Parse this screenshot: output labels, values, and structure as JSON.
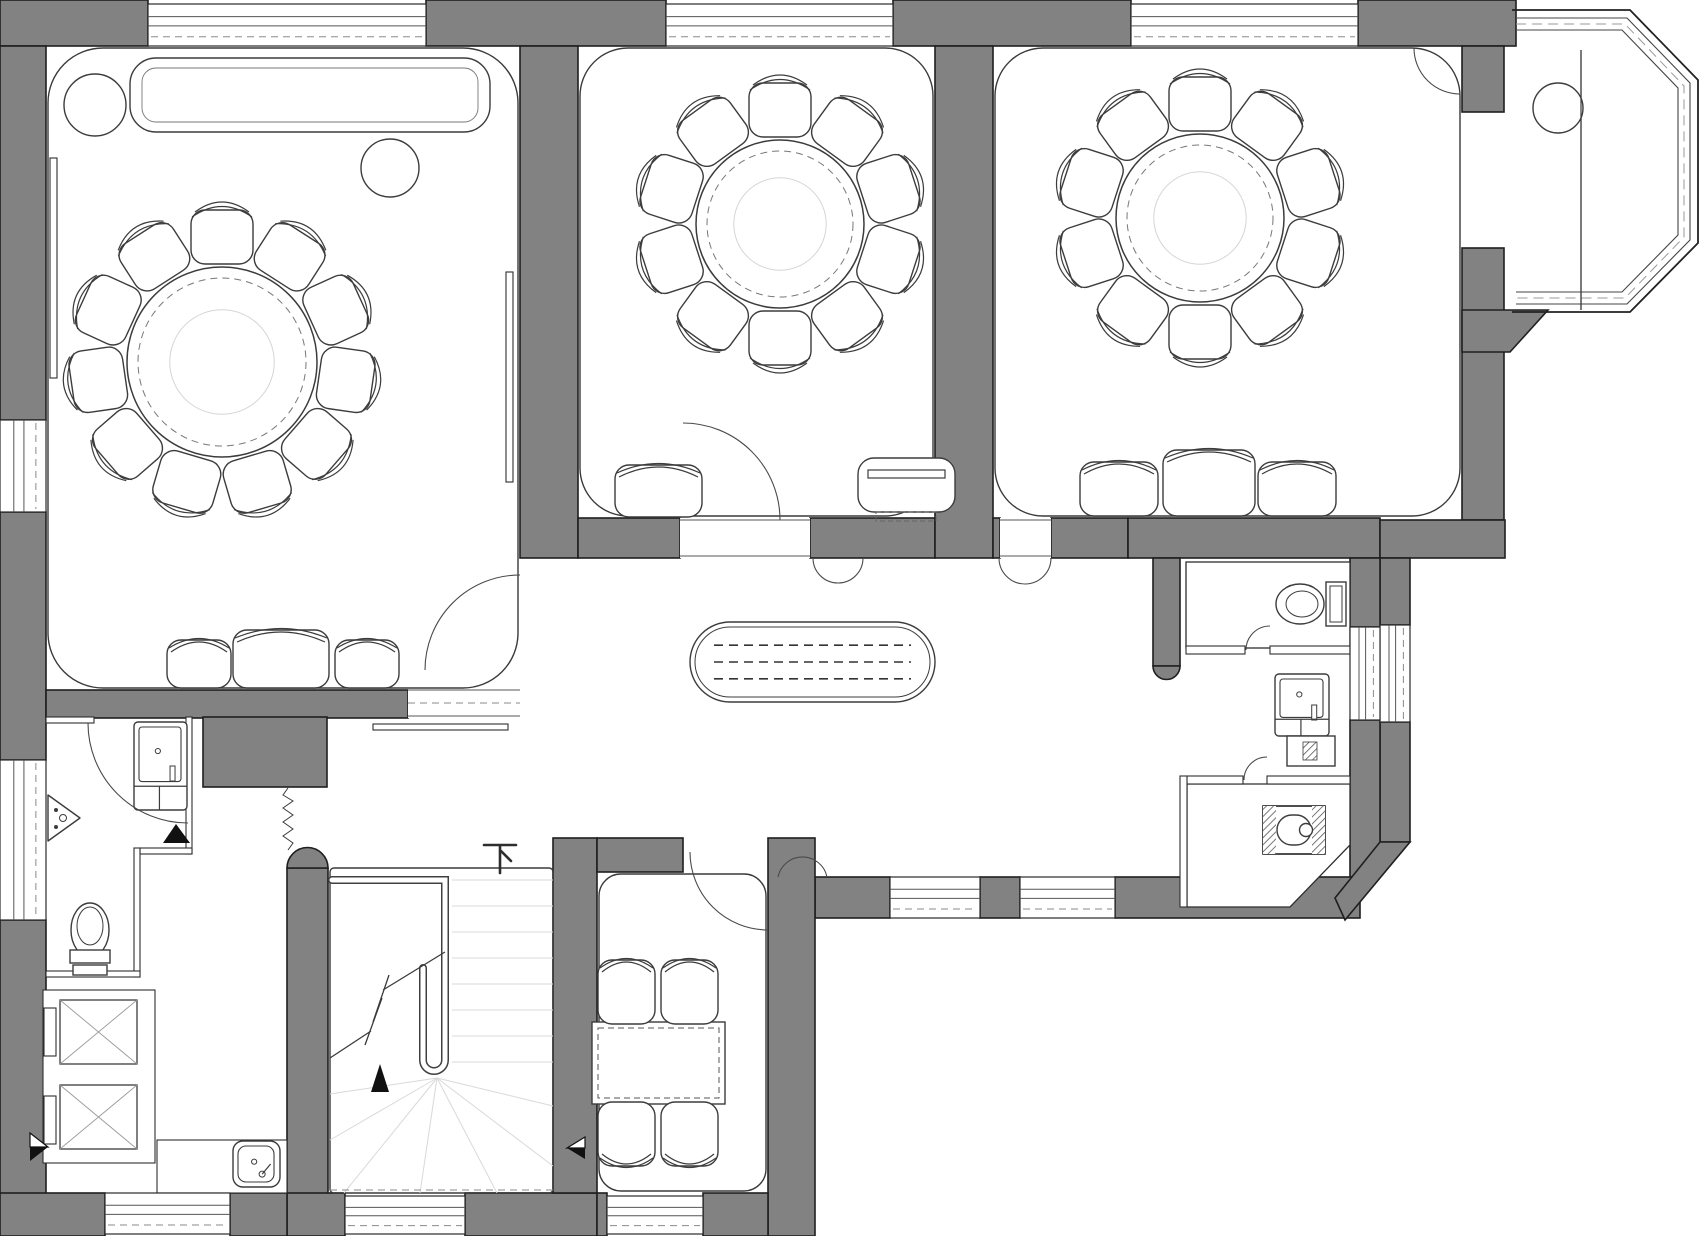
{
  "meta": {
    "title": "restaurant-floor-plan",
    "canvas": {
      "w": 1700,
      "h": 1236
    }
  },
  "palette": {
    "wall": "#828282",
    "wall_stroke": "#1f1f1f",
    "line": "#3c3c3c",
    "faint": "#d9d9d9",
    "dash": "#5a5a5a",
    "paper": "#ffffff",
    "black": "#111111"
  },
  "labels": {
    "stair_down": "下"
  },
  "walls": {
    "rects": [
      [
        0,
        0,
        148,
        46,
        "top-wall-left"
      ],
      [
        426,
        0,
        240,
        46,
        "top-pier-1"
      ],
      [
        893,
        0,
        238,
        46,
        "top-pier-2"
      ],
      [
        1358,
        0,
        158,
        46,
        "top-pier-3"
      ],
      [
        1462,
        46,
        42,
        66,
        "bay-left-pier"
      ],
      [
        1462,
        248,
        42,
        272,
        "bay-right-wall"
      ],
      [
        0,
        46,
        46,
        374,
        "left-wall-upper"
      ],
      [
        0,
        512,
        46,
        248,
        "left-wall-mid"
      ],
      [
        0,
        920,
        46,
        316,
        "left-wall-lower"
      ],
      [
        46,
        690,
        362,
        28,
        "room1-bottom-wall"
      ],
      [
        520,
        46,
        58,
        512,
        "divider-room1-room2"
      ],
      [
        578,
        518,
        102,
        40,
        "room2-bottom-wall-left"
      ],
      [
        810,
        518,
        125,
        40,
        "room2-bottom-wall-right"
      ],
      [
        935,
        46,
        58,
        512,
        "divider-room2-room3"
      ],
      [
        993,
        518,
        7,
        40,
        "room3-bottom-wall-a"
      ],
      [
        1051,
        518,
        77,
        40,
        "room3-bottom-wall-b"
      ],
      [
        1128,
        518,
        252,
        40,
        "bathroom-top-wall"
      ],
      [
        1153,
        558,
        27,
        108,
        "bathroom-left-wall"
      ],
      [
        1380,
        520,
        125,
        38,
        "wing-bottom-wall"
      ],
      [
        1380,
        558,
        30,
        67,
        "right-wall-upper"
      ],
      [
        1380,
        722,
        30,
        120,
        "right-wall-lower"
      ],
      [
        1350,
        558,
        30,
        69,
        "wc-strip-upper"
      ],
      [
        1350,
        720,
        30,
        157,
        "wc-strip-lower"
      ],
      [
        815,
        877,
        75,
        41,
        "corridor-bottom-a"
      ],
      [
        980,
        877,
        40,
        41,
        "corridor-bottom-b"
      ],
      [
        1115,
        877,
        245,
        41,
        "corridor-bottom-c"
      ],
      [
        203,
        717,
        124,
        70,
        "entry-top-wall"
      ],
      [
        287,
        868,
        41,
        368,
        "stair-left-wall"
      ],
      [
        287,
        1193,
        58,
        43,
        "stair-bottom-wall-l"
      ],
      [
        465,
        1193,
        132,
        43,
        "stair-bottom-wall-r"
      ],
      [
        553,
        838,
        44,
        355,
        "dining-left-wall"
      ],
      [
        597,
        838,
        86,
        34,
        "dining-top-stub"
      ],
      [
        768,
        838,
        47,
        398,
        "dining-right-wall"
      ],
      [
        597,
        1193,
        10,
        43,
        "dining-bottom-a"
      ],
      [
        703,
        1193,
        65,
        43,
        "dining-bottom-b"
      ],
      [
        0,
        1193,
        105,
        43,
        "bottom-left-corner"
      ],
      [
        230,
        1193,
        57,
        43,
        "bottom-mid-wall"
      ]
    ],
    "polys": [
      [
        "1462,310 1548,310 1510,352 1462,352",
        "bay-bottom-pier"
      ],
      [
        "1380,842 1410,842 1345,920 1335,898",
        "corner-chamfer-wall"
      ]
    ],
    "caps": [
      [
        "M 287 868 A 20.5 20.5 0 0 1 328 868 Z",
        "stair-wall-round-cap"
      ],
      [
        "M 1153 666 A 13.5 13.5 0 0 0 1180 666 Z",
        "bathroom-wall-round-cap"
      ]
    ]
  },
  "interiors": {
    "rects": [
      [
        1186,
        562,
        164,
        86,
        "wc-room-floor"
      ]
    ],
    "polys": [
      [
        "1187,784 1350,784 1350,845 1290,907 1187,907",
        "squat-room-floor"
      ]
    ]
  },
  "thin_walls": [
    [
      1186,
      646,
      59,
      8,
      "wc-bottom-wall-a"
    ],
    [
      1270,
      646,
      80,
      8,
      "wc-bottom-wall-b"
    ],
    [
      1187,
      776,
      56,
      8,
      "squat-top-wall-a"
    ],
    [
      1267,
      776,
      83,
      8,
      "squat-top-wall-b"
    ],
    [
      1180,
      776,
      7,
      131,
      "squat-left-wall"
    ],
    [
      46,
      717,
      48,
      6,
      "bath-top-wall"
    ],
    [
      186,
      717,
      6,
      137,
      "bath-right-wall-upper"
    ],
    [
      140,
      848,
      52,
      6,
      "bath-step-wall"
    ],
    [
      134,
      848,
      6,
      129,
      "bath-right-wall-lower"
    ],
    [
      46,
      971,
      94,
      6,
      "bath-bottom-wall"
    ],
    [
      43,
      990,
      112,
      173,
      "shaft-room-walls"
    ],
    [
      157,
      1140,
      130,
      53,
      "sink-room-walls"
    ]
  ],
  "outlines": [
    [
      48,
      48,
      470,
      640,
      55,
      "room1-floor-outline"
    ],
    [
      580,
      48,
      353,
      468,
      48,
      "room2-floor-outline"
    ],
    [
      995,
      48,
      465,
      468,
      48,
      "room3-floor-outline"
    ],
    [
      330,
      868,
      223,
      325,
      4,
      "stairwell-outline"
    ],
    [
      599,
      874,
      167,
      317,
      22,
      "dining-room-outline"
    ]
  ],
  "windows": [
    {
      "x": 148,
      "y": 4,
      "w": 278,
      "h": 42,
      "o": "h",
      "name": "window-room1-top"
    },
    {
      "x": 666,
      "y": 4,
      "w": 227,
      "h": 42,
      "o": "h",
      "name": "window-room2-top"
    },
    {
      "x": 1131,
      "y": 4,
      "w": 227,
      "h": 42,
      "o": "h",
      "name": "window-room3-top"
    },
    {
      "x": 890,
      "y": 877,
      "w": 90,
      "h": 41,
      "o": "h",
      "name": "window-corridor-a"
    },
    {
      "x": 1020,
      "y": 877,
      "w": 95,
      "h": 41,
      "o": "h",
      "name": "window-corridor-b"
    },
    {
      "x": 345,
      "y": 1196,
      "w": 120,
      "h": 38,
      "o": "h",
      "name": "window-stair"
    },
    {
      "x": 607,
      "y": 1196,
      "w": 96,
      "h": 38,
      "o": "h",
      "name": "window-dining"
    },
    {
      "x": 105,
      "y": 1193,
      "w": 125,
      "h": 41,
      "o": "h",
      "name": "window-bottom-left"
    },
    {
      "x": 0,
      "y": 420,
      "w": 46,
      "h": 92,
      "o": "v",
      "name": "window-left-upper"
    },
    {
      "x": 0,
      "y": 760,
      "w": 46,
      "h": 160,
      "o": "v",
      "name": "window-left-lower"
    },
    {
      "x": 1380,
      "y": 625,
      "w": 30,
      "h": 97,
      "o": "v",
      "name": "window-right"
    },
    {
      "x": 1350,
      "y": 627,
      "w": 30,
      "h": 93,
      "o": "v",
      "name": "shaft-slot-right"
    }
  ],
  "gaps": [
    {
      "x": 408,
      "y": 688,
      "w": 112,
      "h": 30,
      "name": "door-gap-room1"
    },
    {
      "x": 680,
      "y": 518,
      "w": 130,
      "h": 40,
      "name": "door-gap-room2"
    },
    {
      "x": 1000,
      "y": 518,
      "w": 51,
      "h": 40,
      "name": "door-gap-room3"
    }
  ],
  "bay": {
    "outer": "1512,10 1630,10 1698,80 1698,243 1630,312 1512,312",
    "inner1": "1516,18 1627,18 1690,83 1690,240 1627,304 1516,304",
    "inner2": "1516,30 1622,30 1678,88 1678,235 1622,292 1516,292",
    "dash": "1516,24 1625,24 1684,86 1684,237 1625,298 1516,298",
    "divider_line": [
      1581,
      50,
      1581,
      310
    ],
    "name": "bay-window"
  },
  "furniture": {
    "round_tables": [
      {
        "cx": 222,
        "cy": 362,
        "r": 95,
        "chairs": 11,
        "name": "round-banquet-table-1"
      },
      {
        "cx": 780,
        "cy": 224,
        "r": 84,
        "chairs": 10,
        "name": "round-banquet-table-2"
      },
      {
        "cx": 1200,
        "cy": 218,
        "r": 84,
        "chairs": 10,
        "name": "round-banquet-table-3"
      }
    ],
    "cabinet": {
      "x": 130,
      "y": 58,
      "w": 360,
      "h": 74,
      "name": "long-cabinet"
    },
    "circles": [
      [
        95,
        105,
        31,
        "side-table-1"
      ],
      [
        390,
        168,
        29,
        "side-table-2"
      ],
      [
        1558,
        108,
        25,
        "bay-side-table"
      ]
    ],
    "radiators": [
      [
        50,
        158,
        7,
        220,
        "radiator-left"
      ],
      [
        506,
        272,
        7,
        210,
        "radiator-right"
      ]
    ],
    "threshold": [
      373,
      724,
      135,
      6,
      "corridor-threshold"
    ],
    "benches": [
      {
        "x": 167,
        "y": 640,
        "w": 64,
        "h": 48,
        "hatch": true,
        "name": "bench-seat"
      },
      {
        "x": 233,
        "y": 630,
        "w": 96,
        "h": 58,
        "hatch": false,
        "name": "sofa-seat"
      },
      {
        "x": 335,
        "y": 640,
        "w": 64,
        "h": 48,
        "hatch": true,
        "name": "bench-seat"
      },
      {
        "x": 615,
        "y": 465,
        "w": 87,
        "h": 52,
        "hatch": true,
        "name": "lounge-chair"
      },
      {
        "x": 1080,
        "y": 462,
        "w": 78,
        "h": 54,
        "hatch": true,
        "name": "bench-seat"
      },
      {
        "x": 1163,
        "y": 450,
        "w": 92,
        "h": 66,
        "hatch": false,
        "name": "sofa-seat"
      },
      {
        "x": 1258,
        "y": 462,
        "w": 78,
        "h": 54,
        "hatch": true,
        "name": "bench-seat"
      }
    ],
    "tv": {
      "x": 858,
      "y": 458,
      "w": 97,
      "h": 54,
      "name": "tv-cabinet"
    },
    "stadium_table": {
      "x": 690,
      "y": 622,
      "w": 245,
      "h": 80,
      "name": "corridor-service-table"
    },
    "rect_table": {
      "x": 592,
      "y": 1022,
      "w": 133,
      "h": 82,
      "name": "dining-table"
    },
    "dining_chairs": [
      {
        "x": 598,
        "y": 960,
        "w": 57,
        "h": 64,
        "dir": "up"
      },
      {
        "x": 661,
        "y": 960,
        "w": 57,
        "h": 64,
        "dir": "up"
      },
      {
        "x": 598,
        "y": 1102,
        "w": 57,
        "h": 64,
        "dir": "down"
      },
      {
        "x": 661,
        "y": 1102,
        "w": 57,
        "h": 64,
        "dir": "down"
      }
    ],
    "toilet_right": {
      "cx": 1300,
      "cy": 604,
      "name": "wall-hung-toilet"
    },
    "toilet_left": {
      "cx": 90,
      "cy": 930,
      "name": "toilet"
    },
    "squat": {
      "x": 1263,
      "y": 806,
      "w": 62,
      "h": 48,
      "name": "squat-toilet"
    },
    "sinks": [
      {
        "x": 1275,
        "y": 674,
        "w": 54,
        "h": 62,
        "counter": [
          1287,
          736,
          48,
          30
        ],
        "name": "washbasin-right"
      },
      {
        "x": 134,
        "y": 722,
        "w": 53,
        "h": 88,
        "counter": null,
        "name": "washbasin-left"
      },
      {
        "x": 233,
        "y": 1141,
        "w": 47,
        "h": 46,
        "small": true,
        "name": "mop-sink"
      }
    ],
    "corner_basin": {
      "points": "48,795 48,841 80,818",
      "name": "corner-basin"
    },
    "shafts": [
      {
        "x": 60,
        "y": 1000,
        "w": 77,
        "h": 64,
        "name": "dumbwaiter-shaft"
      },
      {
        "x": 60,
        "y": 1085,
        "w": 77,
        "h": 64,
        "name": "dumbwaiter-shaft"
      },
      {
        "door": [
          44,
          1008,
          12,
          48
        ]
      },
      {
        "door": [
          44,
          1096,
          12,
          48
        ]
      }
    ]
  },
  "stair": {
    "rail": "M 332 880 L 445 880 L 445 1060 A 11 11 0 0 1 423 1060 L 423 968",
    "treads_x": [
      452,
      553
    ],
    "treads_y": [
      880,
      906,
      932,
      958,
      984,
      1010,
      1036,
      1062
    ],
    "fan_pivot": [
      437,
      1078
    ],
    "fan_targets": [
      [
        330,
        1094
      ],
      [
        330,
        1140
      ],
      [
        344,
        1193
      ],
      [
        420,
        1193
      ],
      [
        497,
        1193
      ],
      [
        553,
        1166
      ],
      [
        553,
        1106
      ]
    ],
    "break_line": "M 330 1058 L 371 1031 M 365 1045 L 382 998 M 373 1022 L 389 975 M 383 990 L 445 952",
    "dash_bottom": [
      330,
      1190,
      553,
      1190
    ],
    "arrow": "380,1064 389,1092 371,1092",
    "label_pos": [
      500,
      845
    ],
    "name": "staircase"
  },
  "arcs": [
    {
      "d": "M 425 670 A 95 95 0 0 1 520 575",
      "name": "door-swing-room1"
    },
    {
      "d": "M 683 423 A 97 97 0 0 1 780 520",
      "name": "door-swing-room2"
    },
    {
      "d": "M 813 558 A 25 25 0 0 0 863 558",
      "name": "door-leaf-room2"
    },
    {
      "d": "M 999 558 A 26 26 0 0 0 1051 558",
      "name": "door-leaf-room3"
    },
    {
      "d": "M 88 723 A 100 100 0 0 0 188 823",
      "name": "door-swing-bathroom"
    },
    {
      "d": "M 690 852 A 78 78 0 0 0 768 930",
      "name": "door-swing-dining"
    },
    {
      "d": "M 778 877 A 25 25 0 0 1 827 877",
      "name": "door-leaf-corridor"
    },
    {
      "d": "M 1414 48 A 46 46 0 0 0 1460 94",
      "name": "door-swing-bay"
    },
    {
      "d": "M 1246 650 A 24 24 0 0 1 1270 626",
      "name": "door-swing-wc"
    },
    {
      "d": "M 1244 780 A 23 23 0 0 1 1267 757",
      "name": "door-swing-squat"
    }
  ],
  "markers": [
    {
      "white": "30,1133 48,1147 30,1147",
      "black": "30,1147 48,1147 30,1161",
      "name": "section-marker-left"
    },
    {
      "white": "585,1137 567,1148 585,1148",
      "black": "585,1148 567,1148 585,1159",
      "name": "section-marker-dining"
    }
  ],
  "black_arrows": [
    {
      "points": "176,824 190,843 163,843",
      "name": "entry-arrow-bathroom"
    }
  ],
  "coil": {
    "d": "M 288 788 L 283 795 L 293 801 L 283 808 L 293 815 L 283 822 L 293 829 L 283 836 L 293 843 L 288 850",
    "name": "door-closer-coil"
  },
  "misc_lines": [
    {
      "x1": 1581,
      "y1": 50,
      "x2": 1581,
      "y2": 310,
      "cls": "ln",
      "name": "bay-mullion-line"
    },
    {
      "x1": 408,
      "y1": 703,
      "x2": 520,
      "y2": 703,
      "cls": "windash",
      "name": "room1-gap-dash"
    },
    {
      "x1": 330,
      "y1": 1190,
      "x2": 553,
      "y2": 1190,
      "cls": "windash",
      "name": "stair-bottom-dash"
    }
  ]
}
